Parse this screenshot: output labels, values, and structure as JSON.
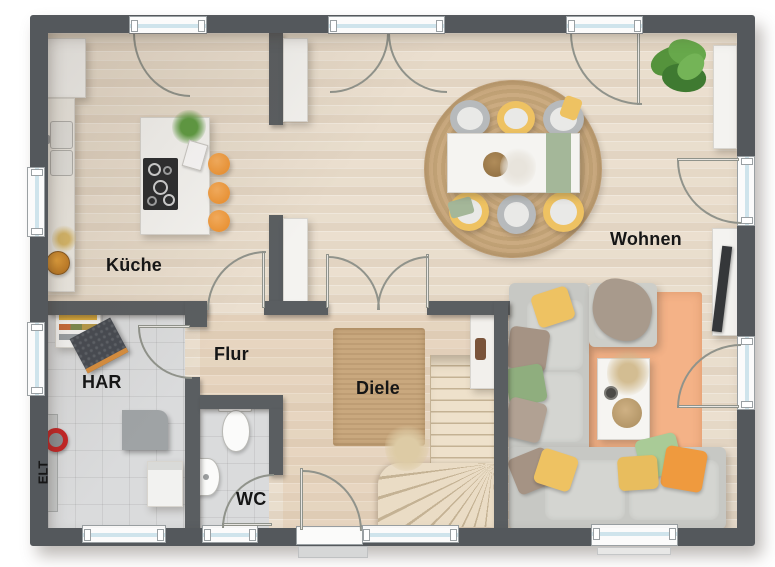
{
  "rooms": {
    "kueche": "Küche",
    "wohnen": "Wohnen",
    "flur": "Flur",
    "diele": "Diele",
    "har": "HAR",
    "wc": "WC",
    "elt": "ELT"
  },
  "colors": {
    "wall": "#54585c",
    "wood_floor": "#e7dccb",
    "tile_floor": "#dadbdc",
    "window_glass": "#cfe4ec",
    "door_arc": "#90938b",
    "stool_orange": "#ef9a3e",
    "chair_yellow": "#eec262",
    "runner_green": "#a4b799",
    "rug_jute": "#c9a87e",
    "rug_orange": "#f4b287",
    "sofa_gray": "#c7c8c4",
    "stairs_wood": "#ecdfc9"
  }
}
